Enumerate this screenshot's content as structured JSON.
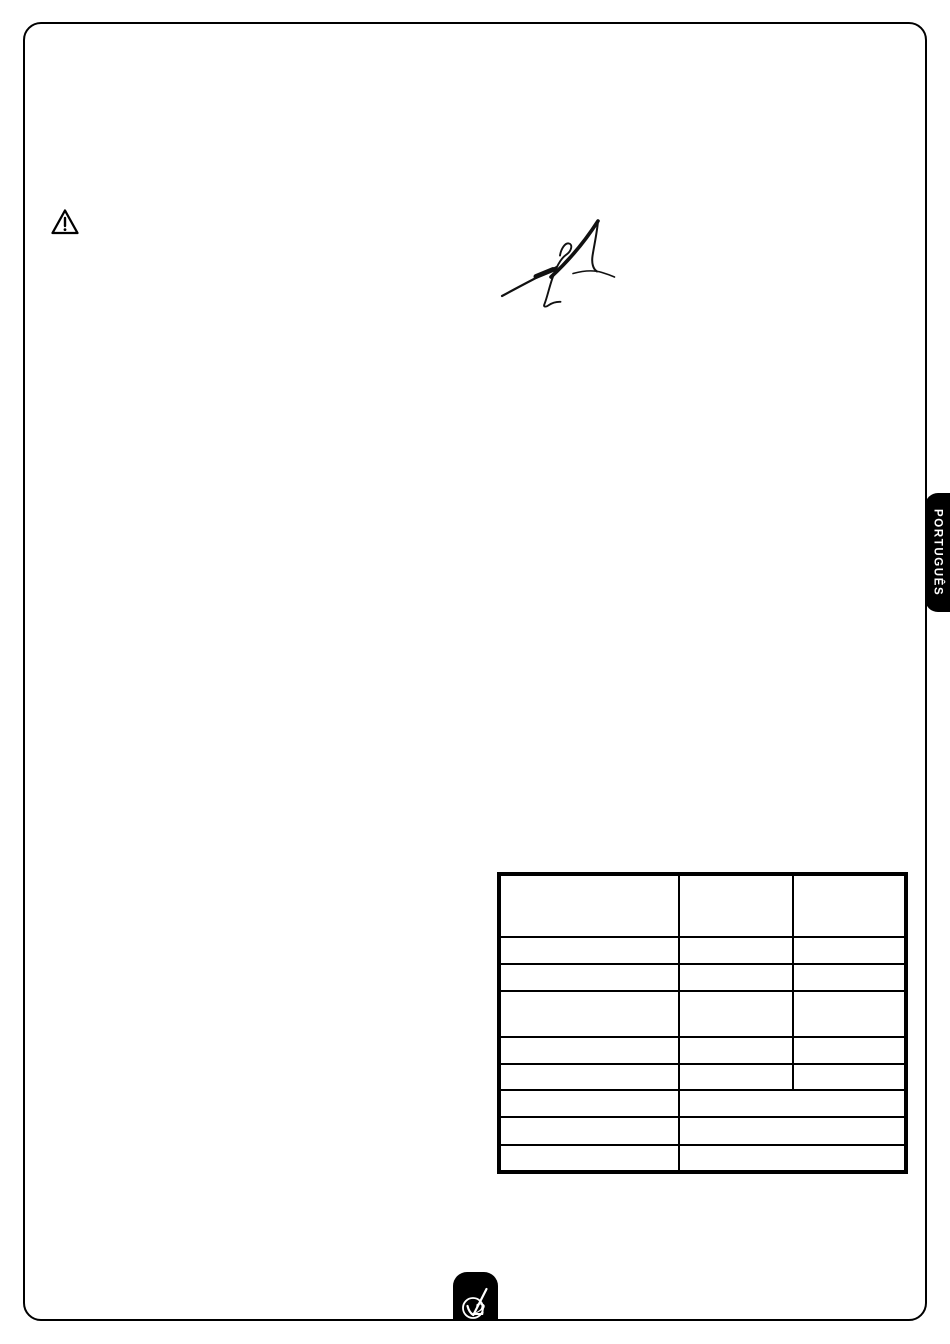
{
  "document": {
    "language_tab": {
      "label": "PORTUGUÊS"
    },
    "colors": {
      "ink": "#000000",
      "paper": "#ffffff",
      "tab_background": "#000000",
      "tab_text": "#ffffff"
    },
    "icons": {
      "warning": "warning-triangle-icon",
      "brand": "v2-logo",
      "signature": "handwritten-signature"
    },
    "table": {
      "columns": 3,
      "rows": [
        [
          "",
          "",
          ""
        ],
        [
          "",
          "",
          ""
        ],
        [
          "",
          "",
          ""
        ],
        [
          "",
          "",
          ""
        ],
        [
          "",
          "",
          ""
        ],
        [
          "",
          "",
          ""
        ],
        [
          "",
          ""
        ],
        [
          "",
          ""
        ],
        [
          "",
          ""
        ]
      ]
    }
  }
}
